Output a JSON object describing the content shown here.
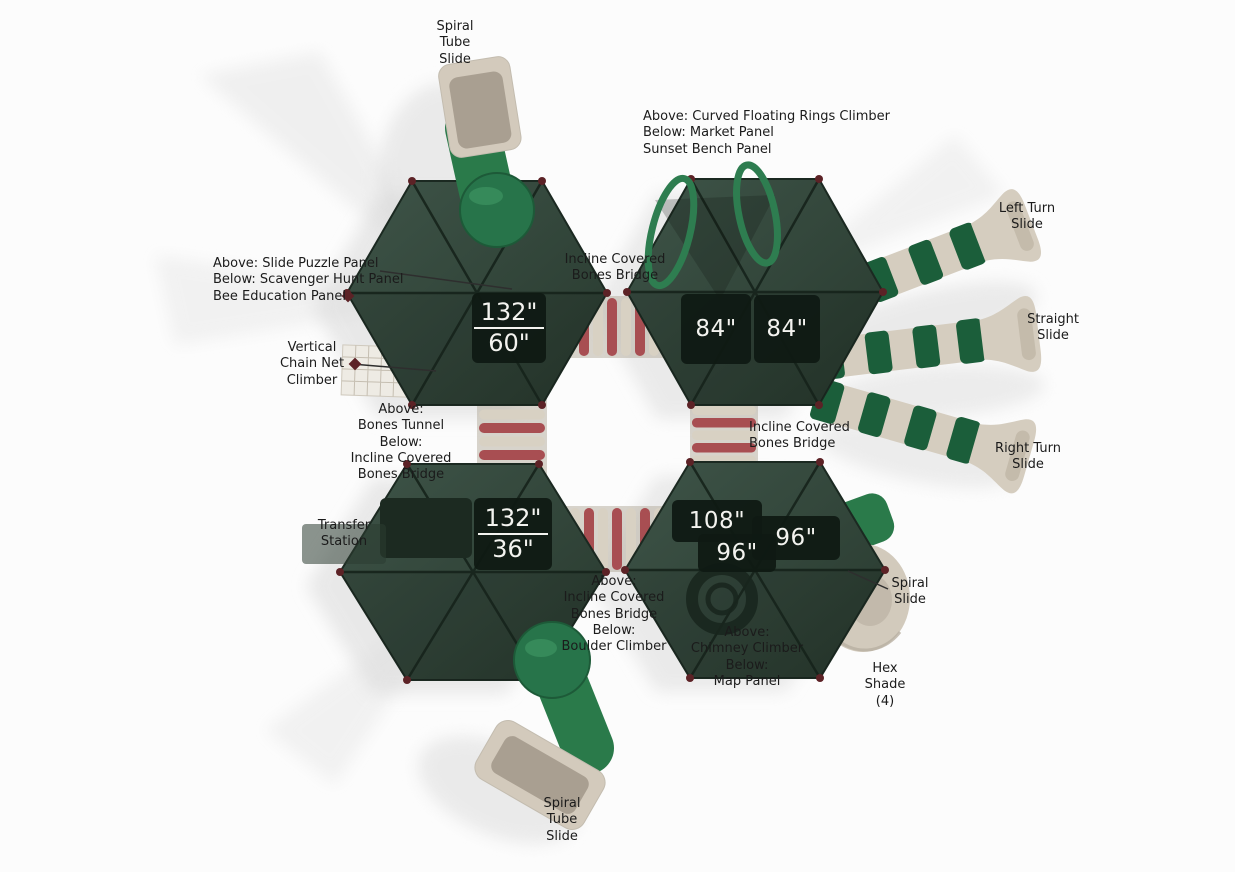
{
  "figure": {
    "type": "playground-structure-top-view"
  },
  "colors": {
    "background": "#fcfcfc",
    "canopy_green": "#33463a",
    "canopy_edge": "#1b2921",
    "tube_green": "#2a7a4a",
    "slide_beige": "#d5cdbf",
    "stripe_green": "#1b5e3a",
    "bridge_red": "#a84e52",
    "bridge_cream": "#d8d1c3",
    "corner_marker": "#5c2226",
    "deck_box": "#0f1a13",
    "measurement_text": "#f3f3ef",
    "label_text": "#1b1b1b",
    "shadow": "#dddddd"
  },
  "labels": [
    {
      "id": "spiral-tube-slide-top",
      "text": "Spiral\nTube\nSlide"
    },
    {
      "id": "curved-floating-rings-climber",
      "text": "Above: Curved Floating Rings Climber\nBelow: Market Panel\nSunset Bench Panel"
    },
    {
      "id": "left-turn-slide",
      "text": "Left Turn\nSlide"
    },
    {
      "id": "slide-puzzle-panel",
      "text": "Above: Slide Puzzle Panel\nBelow: Scavenger Hunt Panel\nBee Education Panel"
    },
    {
      "id": "incline-covered-bones-bridge-top",
      "text": "Incline Covered\nBones Bridge"
    },
    {
      "id": "straight-slide",
      "text": "Straight\nSlide"
    },
    {
      "id": "vertical-chain-net-climber",
      "text": "Vertical\nChain Net\nClimber"
    },
    {
      "id": "bones-tunnel",
      "text": "Above:\nBones Tunnel\nBelow:\nIncline Covered\nBones Bridge"
    },
    {
      "id": "incline-covered-bones-bridge-right",
      "text": "Incline Covered\nBones Bridge"
    },
    {
      "id": "right-turn-slide",
      "text": "Right Turn\nSlide"
    },
    {
      "id": "transfer-station",
      "text": "Transfer\nStation"
    },
    {
      "id": "spiral-slide",
      "text": "Spiral\nSlide"
    },
    {
      "id": "incline-bridge-boulder-climber",
      "text": "Above:\nIncline Covered\nBones Bridge\nBelow:\nBoulder Climber"
    },
    {
      "id": "chimney-climber-map-panel",
      "text": "Above:\nChimney Climber\nBelow:\nMap Panel"
    },
    {
      "id": "hex-shade",
      "text": "Hex\nShade\n(4)"
    },
    {
      "id": "spiral-tube-slide-bottom",
      "text": "Spiral\nTube\nSlide"
    }
  ],
  "measurements": {
    "platform_a": {
      "top": "132\"",
      "bottom": "60\""
    },
    "platform_b": "84\"",
    "platform_c": "84\"",
    "platform_d": {
      "top": "132\"",
      "bottom": "36\""
    },
    "platform_e": "108\"",
    "platform_f": "96\"",
    "platform_g": "96\""
  }
}
